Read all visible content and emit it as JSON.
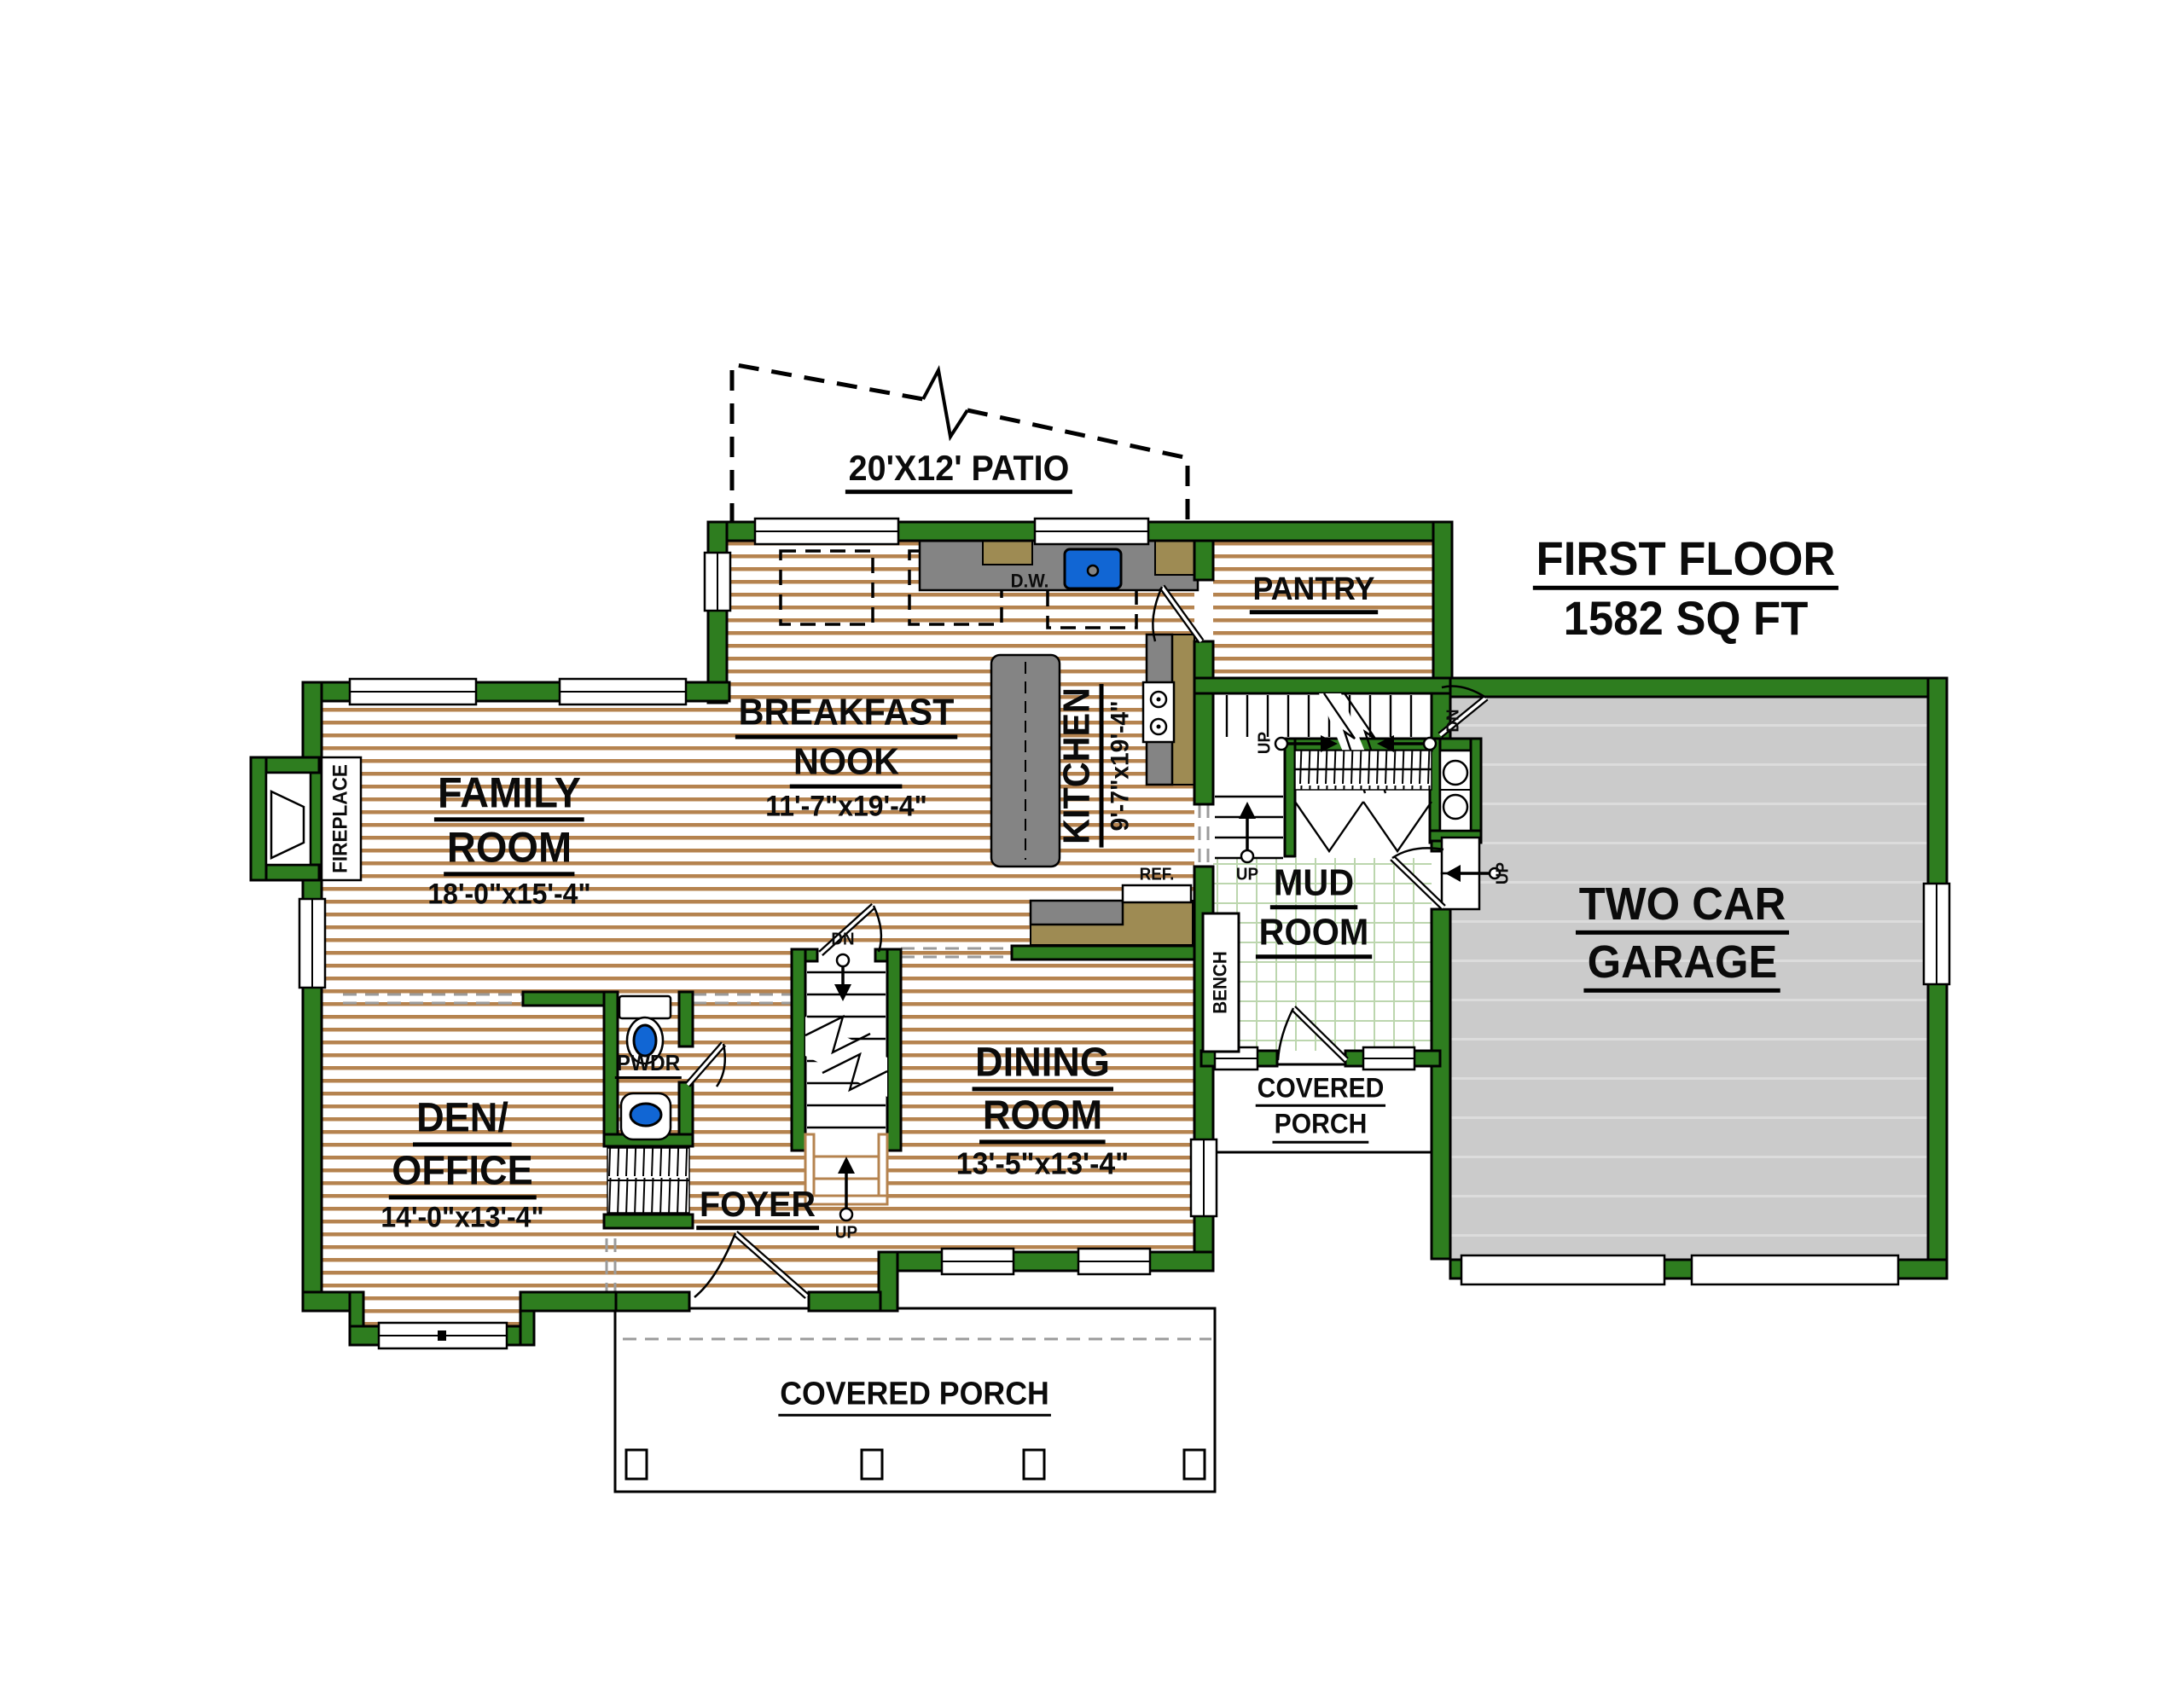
{
  "patio": {
    "label": "20'X12' PATIO"
  },
  "title": {
    "name": "FIRST FLOOR",
    "area": "1582 SQ FT"
  },
  "rooms": {
    "family": {
      "line1": "FAMILY",
      "line2": "ROOM",
      "dims": "18'-0\"x15'-4\""
    },
    "breakfast": {
      "line1": "BREAKFAST",
      "line2": "NOOK",
      "dims": "11'-7\"x19'-4\""
    },
    "kitchen": {
      "line1": "KITCHEN",
      "dims": "9'-7\"x19'-4\""
    },
    "pantry": {
      "line1": "PANTRY"
    },
    "mud": {
      "line1": "MUD",
      "line2": "ROOM"
    },
    "den": {
      "line1": "DEN/",
      "line2": "OFFICE",
      "dims": "14'-0\"x13'-4\""
    },
    "dining": {
      "line1": "DINING",
      "line2": "ROOM",
      "dims": "13'-5\"x13'-4\""
    },
    "foyer": {
      "line1": "FOYER"
    },
    "pwdr": {
      "line1": "PWDR"
    },
    "garage": {
      "line1": "TWO CAR",
      "line2": "GARAGE"
    },
    "porch_front": {
      "line1": "COVERED PORCH"
    },
    "porch_side": {
      "line1": "COVERED",
      "line2": "PORCH"
    }
  },
  "fixtures": {
    "fireplace": "FIREPLACE",
    "bench": "BENCH",
    "refrigerator": "REF.",
    "dishwasher": "D.W."
  },
  "stairs": {
    "up": "UP",
    "down": "DN"
  },
  "colors": {
    "wall": "#2E7D1F",
    "wood_line": "#B5834F",
    "tile_line": "#BCD6AE",
    "garage_floor": "#CBCBCB",
    "counter": "#848484",
    "cabinet": "#9E8B53",
    "fixture_blue": "#1166D4"
  }
}
